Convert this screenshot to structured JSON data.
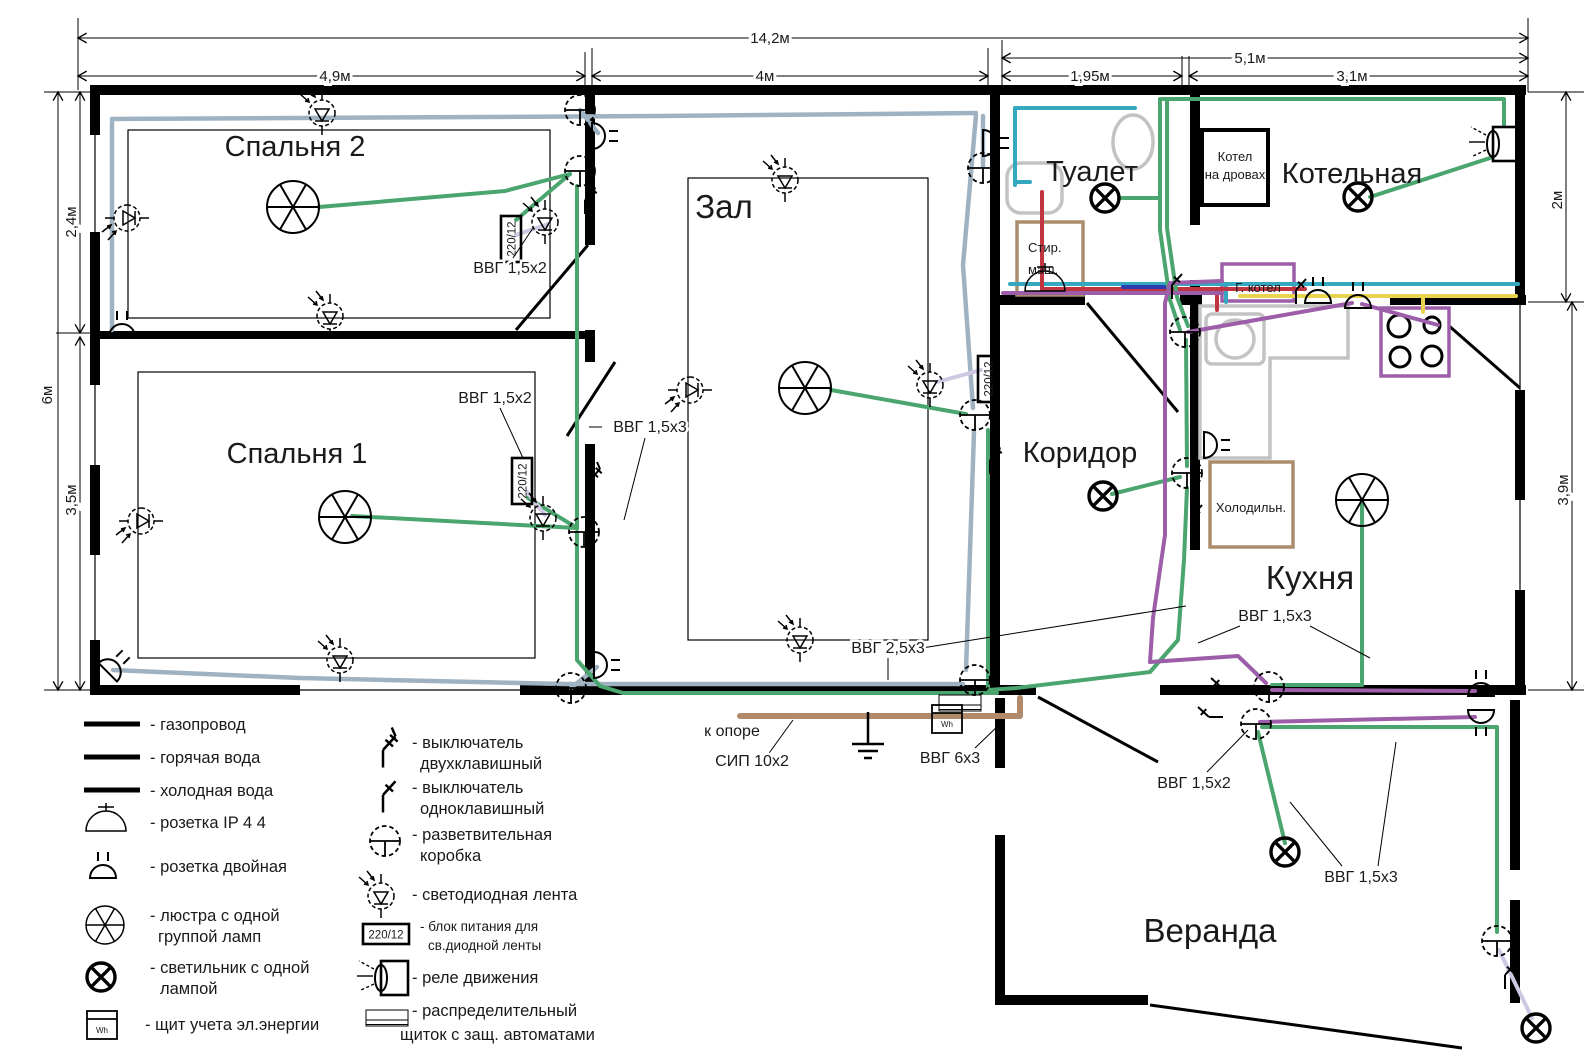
{
  "rooms": {
    "bedroom2": "Спальня 2",
    "bedroom1": "Спальня 1",
    "hall": "Зал",
    "toilet": "Туалет",
    "boiler_room": "Котельная",
    "corridor": "Коридор",
    "kitchen": "Кухня",
    "veranda": "Веранда"
  },
  "appliances": {
    "wood_boiler_l1": "Котел",
    "wood_boiler_l2": "на дровах",
    "gas_boiler": "Г. котел",
    "washer_l1": "Стир.",
    "washer_l2": "маш.",
    "fridge": "Холодильн."
  },
  "dims": {
    "total_w": "14,2м",
    "bedroom2_w": "4,9м",
    "hall_w": "4м",
    "right_w": "5,1м",
    "toilet_w": "1,95м",
    "boiler_w": "3,1м",
    "left_h": "6м",
    "bedroom2_h": "2,4м",
    "bedroom1_h": "3,5м",
    "boiler_h": "2м",
    "kitchen_h": "3,9м"
  },
  "cables": {
    "vvg152": "ВВГ 1,5х2",
    "vvg153": "ВВГ 1,5х3",
    "vvg253": "ВВГ 2,5х3",
    "vvg63": "ВВГ 6х3",
    "sip": "СИП 10х2",
    "to_pole": "к опоре",
    "psu": "220/12",
    "meter": "Wh"
  },
  "legend": {
    "left": [
      {
        "icon": "gas-line",
        "label": "- газопровод"
      },
      {
        "icon": "hot-water-line",
        "label": "- горячая вода"
      },
      {
        "icon": "cold-water-line",
        "label": "- холодная вода"
      },
      {
        "icon": "ip44-socket",
        "label": "- розетка IP 4 4"
      },
      {
        "icon": "double-socket",
        "label": "- розетка двойная"
      },
      {
        "icon": "chandelier",
        "label": "- люстра с одной",
        "label2": "группой ламп"
      },
      {
        "icon": "lamp",
        "label": "- светильник с одной",
        "label2": "лампой"
      },
      {
        "icon": "energy-meter",
        "label": "- щит учета эл.энергии"
      }
    ],
    "middle": [
      {
        "icon": "switch-two-gang",
        "label": "- выключатель",
        "label2": "двухклавишный"
      },
      {
        "icon": "switch-one-gang",
        "label": "- выключатель",
        "label2": "одноклавишный"
      },
      {
        "icon": "junction-box",
        "label": "- разветвительная",
        "label2": "коробка"
      },
      {
        "icon": "led-strip",
        "label": "- светодиодная лента"
      },
      {
        "icon": "led-psu",
        "label": "- блок питания для",
        "label2": "св.диодной ленты"
      },
      {
        "icon": "motion-relay",
        "label": "- реле движения"
      },
      {
        "icon": "distribution-panel",
        "label": "- распределительный",
        "label2": "щиток с защ. автоматами"
      }
    ]
  },
  "colors": {
    "gas": "#e8d44d",
    "hot_water": "#c03540",
    "cold_water": "#35a8c0",
    "wire_lighting": "#4aa56e",
    "wire_sockets": "#9fb2c2",
    "wire_kitchen": "#9c5ea9",
    "wire_led_feed": "#cfc8e2",
    "sip_cable": "#b08a6b"
  }
}
